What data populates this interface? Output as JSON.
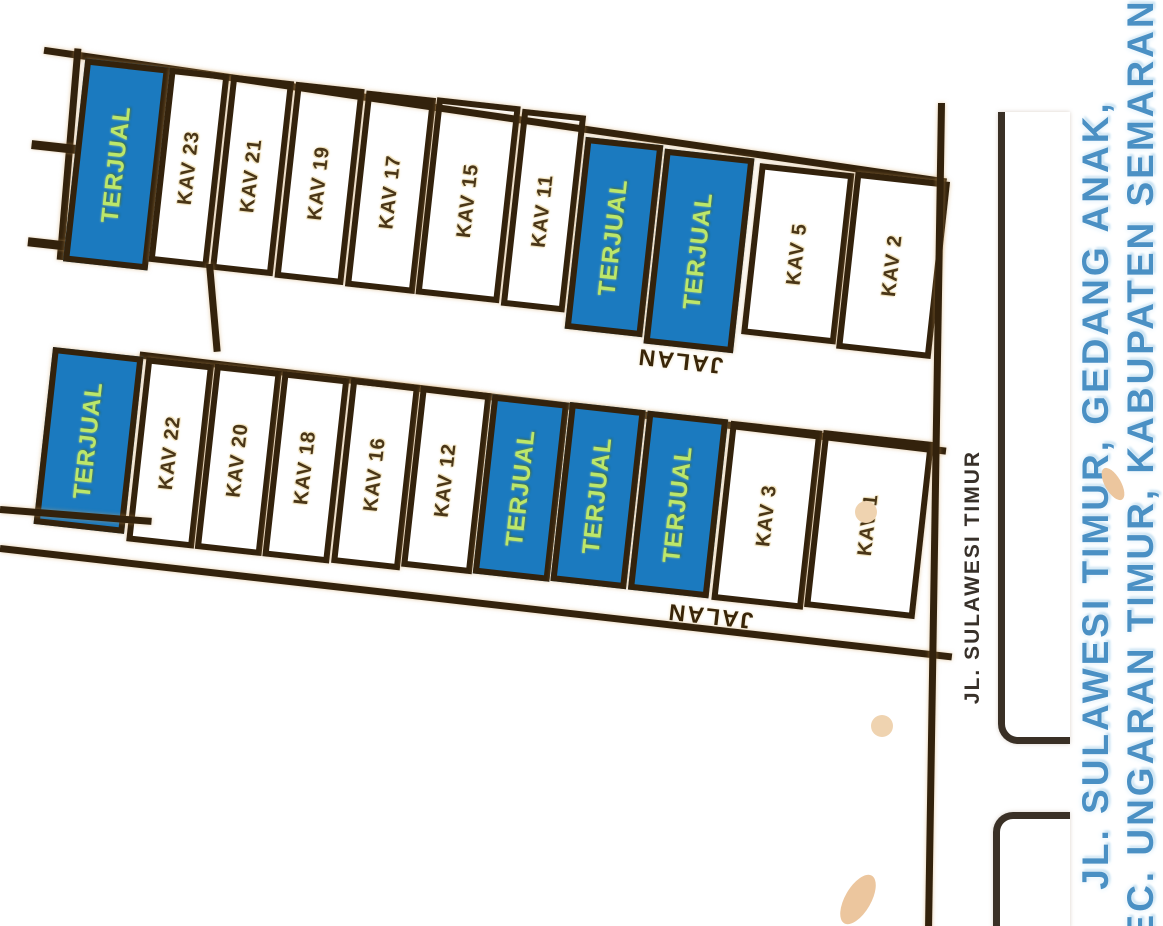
{
  "title": {
    "line1": "JL. SULAWESI TIMUR, GEDANG ANAK,",
    "line2": "KEC. UNGARAN TIMUR, KABUPATEN SEMARANG"
  },
  "roads": {
    "middle_label": "JALAN",
    "bottom_label": "JALAN",
    "side_label": "JL. SULAWESI TIMUR"
  },
  "sold_label": "TERJUAL",
  "rows": {
    "row1": {
      "plots": [
        {
          "label": "TERJUAL",
          "status": "sold"
        },
        {
          "label": "KAV 23",
          "status": "available"
        },
        {
          "label": "KAV 21",
          "status": "available"
        },
        {
          "label": "KAV 19",
          "status": "available"
        },
        {
          "label": "KAV 17",
          "status": "available"
        },
        {
          "label": "KAV 15",
          "status": "available"
        },
        {
          "label": "KAV 11",
          "status": "available"
        },
        {
          "label": "TERJUAL",
          "status": "sold"
        },
        {
          "label": "TERJUAL",
          "status": "sold"
        },
        {
          "label": "KAV 5",
          "status": "available"
        },
        {
          "label": "KAV 2",
          "status": "available"
        }
      ]
    },
    "row2": {
      "plots": [
        {
          "label": "TERJUAL",
          "status": "sold"
        },
        {
          "label": "KAV 22",
          "status": "available"
        },
        {
          "label": "KAV 20",
          "status": "available"
        },
        {
          "label": "KAV 18",
          "status": "available"
        },
        {
          "label": "KAV 16",
          "status": "available"
        },
        {
          "label": "KAV 12",
          "status": "available"
        },
        {
          "label": "TERJUAL",
          "status": "sold"
        },
        {
          "label": "TERJUAL",
          "status": "sold"
        },
        {
          "label": "TERJUAL",
          "status": "sold"
        },
        {
          "label": "KAV 3",
          "status": "available"
        },
        {
          "label": "KAV 1",
          "status": "available"
        }
      ]
    }
  },
  "colors": {
    "line": "#33220c",
    "sold-fill": "#1b7abf",
    "sold-text": "#bce76a",
    "kav-text": "#4a3617",
    "road-text": "#392508",
    "side-text": "#38312a",
    "title-blue": "#4a90c4",
    "halo": "#f0e2bd",
    "dot": "#efd3b0"
  }
}
